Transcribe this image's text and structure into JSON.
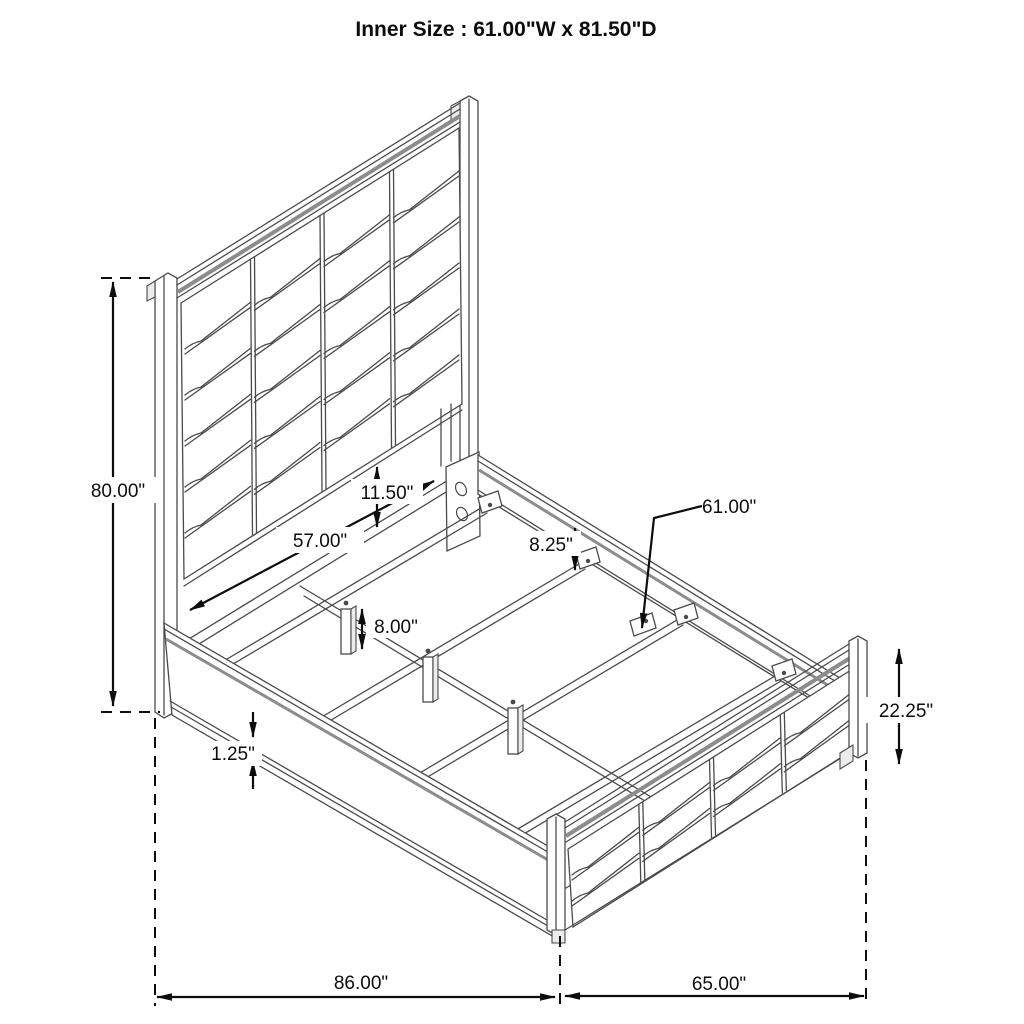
{
  "title": "Inner Size : 61.00\"W x 81.50\"D",
  "dimension_labels": {
    "headboard_height": "80.00\"",
    "headboard_width": "57.00\"",
    "panel_gap": "11.50\"",
    "rail_to_slat": "8.25\"",
    "slat_length": "61.00\"",
    "center_leg_height": "8.00\"",
    "rail_lip": "1.25\"",
    "footboard_height": "22.25\"",
    "overall_depth": "86.00\"",
    "overall_width": "65.00\""
  }
}
